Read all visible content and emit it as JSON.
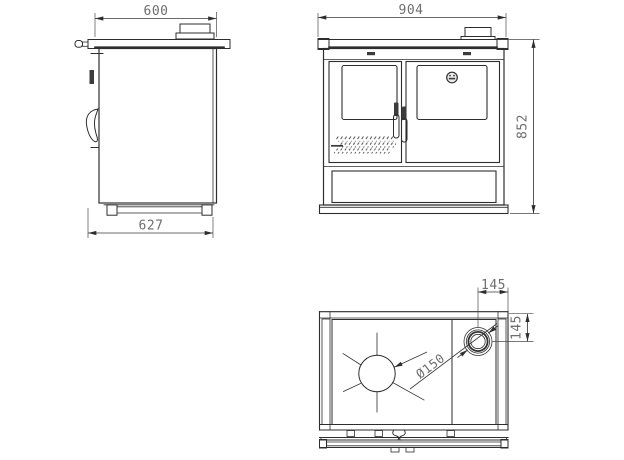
{
  "meta": {
    "background_color": "#ffffff",
    "line_color": "#2e2e2e",
    "dim_text_color": "#6e6e6e",
    "description_labels": {
      "side_view": "side-view",
      "front_view": "front-view",
      "top_view": "top-view"
    }
  },
  "views": {
    "side": {
      "dim_top": "600",
      "dim_bottom": "627"
    },
    "front": {
      "dim_top": "904",
      "dim_right": "852"
    },
    "top": {
      "dim_flue_x": "145",
      "dim_flue_y": "145",
      "dim_flue_diameter": "Ø150"
    }
  }
}
